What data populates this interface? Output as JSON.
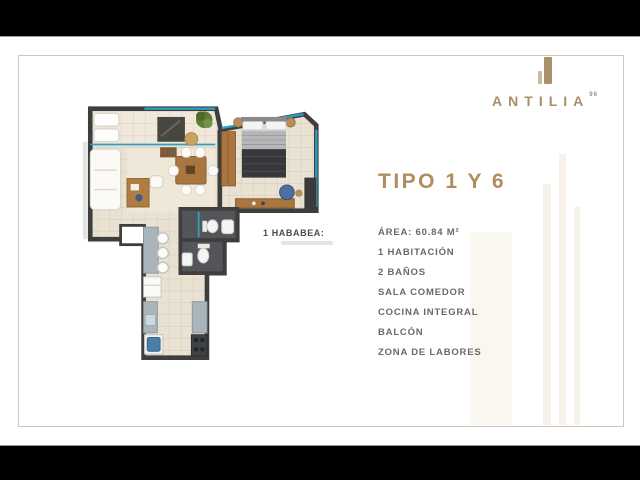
{
  "brand": {
    "name": "ANTILIA",
    "superscript": "96"
  },
  "panel": {
    "title": "TIPO 1 Y 6",
    "specs": [
      "ÁREA: 60.84 M²",
      "1 HABITACIÓN",
      "2 BAÑOS",
      "SALA COMEDOR",
      "COCINA INTEGRAL",
      "BALCÓN",
      "ZONA DE LABORES"
    ]
  },
  "floorplan": {
    "label": "1 HABABEA:",
    "colors": {
      "wall": "#3e3e3e",
      "floor": "#e9e1d2",
      "balcony_floor": "#f0e8da",
      "glass": "#2f9fc0",
      "wood": "#a9763f",
      "tile": "#53555b",
      "counter": "#a9b5bb",
      "washer_blue": "#4a7fa8",
      "gold": "#ab8e68"
    }
  }
}
